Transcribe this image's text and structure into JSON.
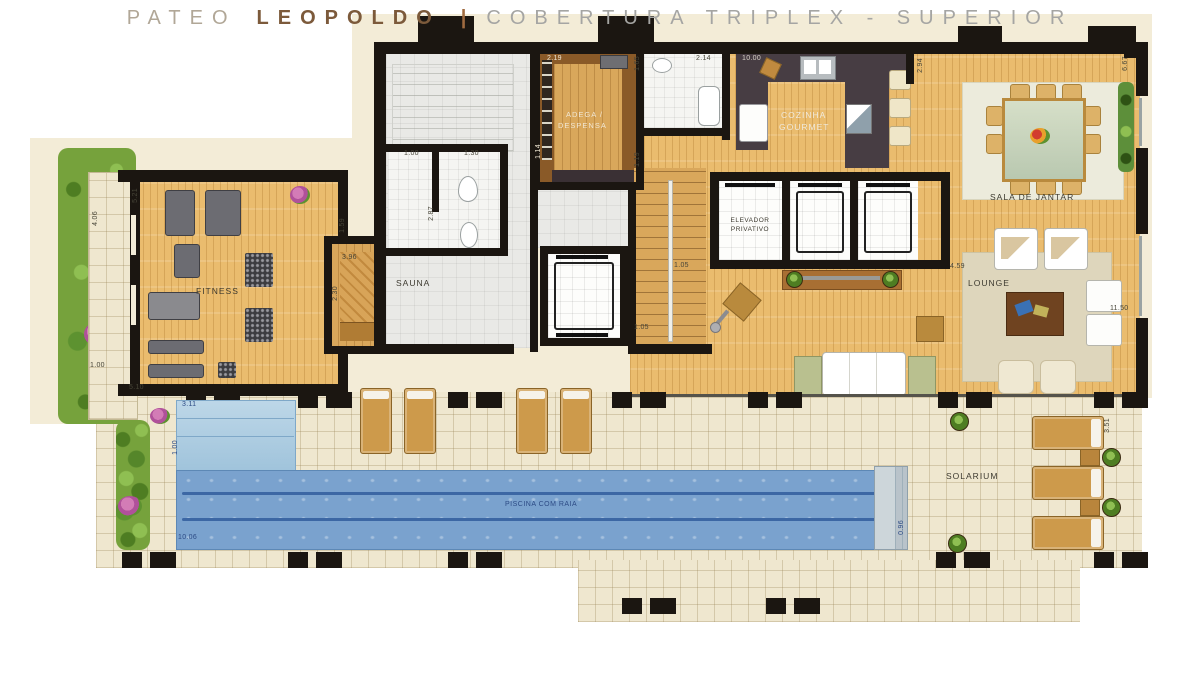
{
  "title": {
    "project_light": "PATEO",
    "project_bold": "LEOPOLDO",
    "separator": "|",
    "subtitle": "COBERTURA TRIPLEX - SUPERIOR"
  },
  "rooms": {
    "fitness": "FITNESS",
    "sauna": "SAUNA",
    "adega_line1": "ADEGA /",
    "adega_line2": "DESPENSA",
    "cozinha_line1": "COZINHA",
    "cozinha_line2": "GOURMET",
    "elevador_line1": "ELEVADOR",
    "elevador_line2": "PRIVATIVO",
    "sala_de_jantar": "SALA DE JANTAR",
    "lounge": "LOUNGE",
    "solarium": "SOLARIUM",
    "piscina": "PISCINA COM RAIA"
  },
  "dims": {
    "garden_h": "4.06",
    "garden_w": "1.00",
    "fitness_top": "5.21",
    "fitness_bottom": "5.10",
    "sauna_entry": "1.59",
    "sauna_w": "3.96",
    "sauna_h": "2.30",
    "wc_door": "1.00",
    "wc_w": "1.30",
    "wc_d": "2.87",
    "adega_w": "2.19",
    "adega_s": "1.14",
    "bath_s": "1.65",
    "bath_w": "2.14",
    "kitchen_w": "10.00",
    "kitchen_s": "2.94",
    "dining_s": "6.67",
    "stair_w": "1.19",
    "stair_s": "1.05",
    "stair_b": "1.05",
    "lounge_l": "4.59",
    "lounge_r": "11.50",
    "solarium_s": "3.51",
    "pool_w": "3.11",
    "pool_lane": "1.00",
    "pool_len": "10.06",
    "pool_end": "0.96"
  },
  "colors": {
    "wall": "#1b1611",
    "slab": "#f3ecd7",
    "deck_tile": "#efe7cf",
    "wood_floor": "#eabc6e",
    "pool_lane": "#7aa2ce",
    "pool_shallow": "#bdd7e8",
    "lane_line": "#3c67a4",
    "grass": "#76a23c",
    "kitchen_counter": "#473d43",
    "title_brown": "#7c5a3b",
    "title_grey": "#a5a5a3"
  }
}
